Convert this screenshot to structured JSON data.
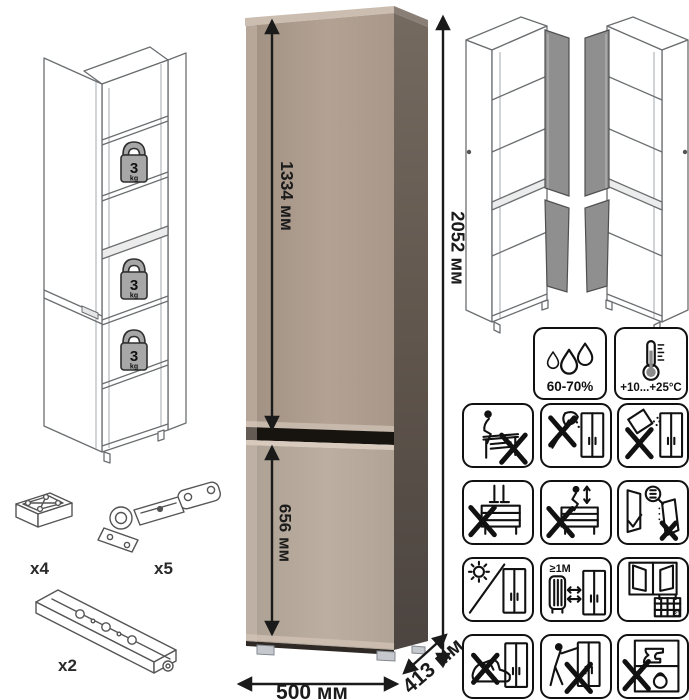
{
  "product_diagram": {
    "shelf_load": {
      "value": "3",
      "unit": "kg"
    },
    "dimensions": {
      "upper_section_height": "1334 мм",
      "lower_section_height": "656 мм",
      "total_height": "2052 мм",
      "width": "500 мм",
      "depth": "413 мм"
    },
    "hardware": {
      "feet_qty": "x4",
      "hinges_qty": "x5",
      "rails_qty": "x2"
    },
    "climate": {
      "humidity_label": "60-70%",
      "temperature_label": "+10...+25°C",
      "icons": [
        "humidity-drops-icon",
        "thermometer-icon"
      ]
    },
    "care": {
      "min_distance_label": "≥1M",
      "calendar_label": "21",
      "items": [
        "no-sitting-on-furniture",
        "no-sharp-tools",
        "no-abrasive-spill",
        "no-standing-on-furniture",
        "no-jumping-on-furniture",
        "door-adjustment-check",
        "avoid-direct-sunlight",
        "keep-1m-from-heat",
        "acclimatize-ventilate-room",
        "no-pushing-with-foot",
        "no-dragging-furniture",
        "no-heavy-items-inside"
      ]
    }
  }
}
